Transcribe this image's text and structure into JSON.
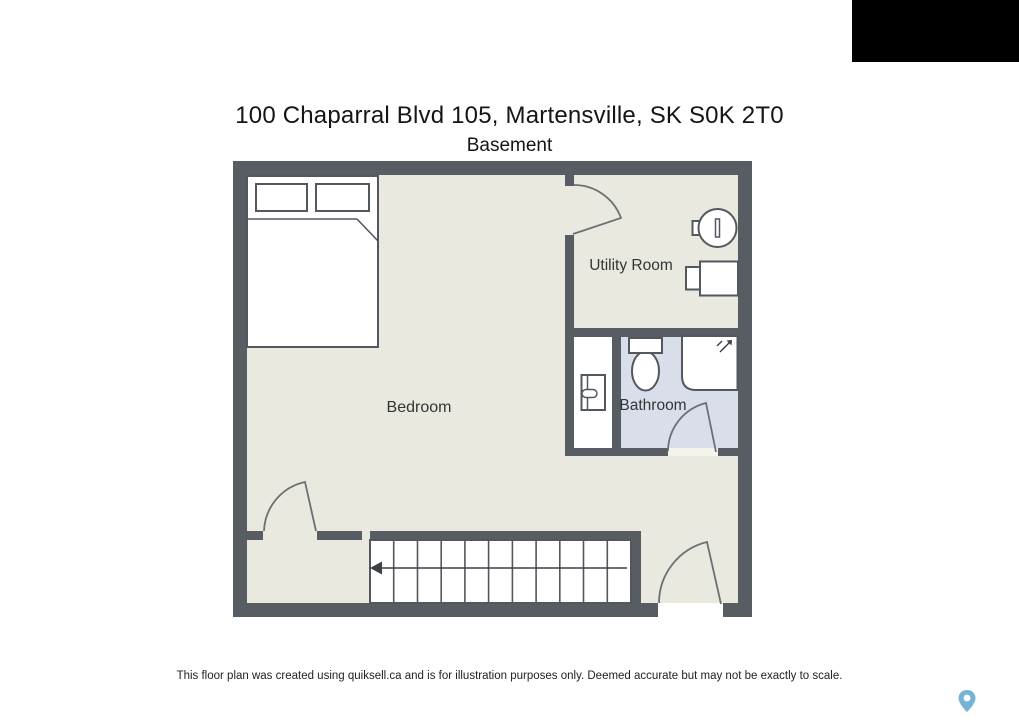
{
  "header": {
    "title": "100 Chaparral Blvd 105, Martensville, SK S0K 2T0",
    "subtitle": "Basement"
  },
  "floor_plan": {
    "rooms": {
      "bedroom": {
        "label": "Bedroom"
      },
      "utility": {
        "label": "Utility Room"
      },
      "bathroom": {
        "label": "Bathroom"
      }
    },
    "fixtures": [
      "bed",
      "pillows",
      "water-heater",
      "washer",
      "toilet",
      "vanity-cabinet",
      "shower",
      "stairs"
    ],
    "stairs": {
      "treads": 11,
      "arrow_direction": "left"
    },
    "colors": {
      "wall": "#585d63",
      "floor": "#eae9df",
      "bathroom_floor": "#d9deea",
      "closet_floor": "#ffffff",
      "fixture_stroke": "#53585e",
      "door_stroke": "#6b7075"
    }
  },
  "footer": {
    "disclaimer": "This floor plan was created using quiksell.ca and is for illustration purposes only. Deemed accurate but may not be exactly to scale.",
    "map_pin_color": "#77b3d6"
  }
}
